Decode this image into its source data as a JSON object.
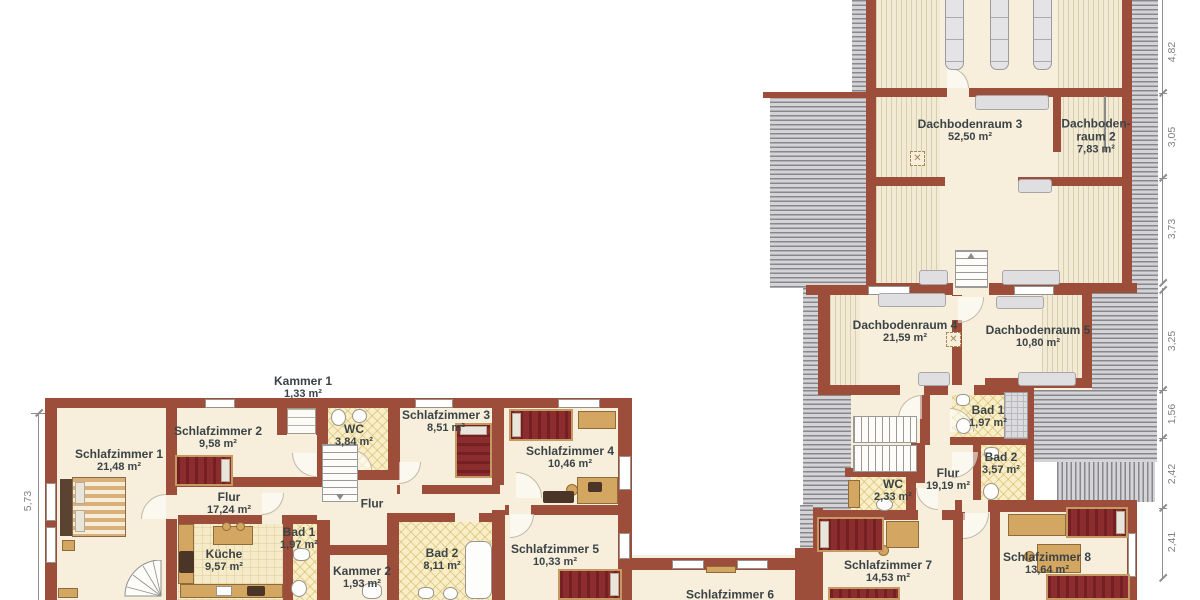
{
  "rooms": {
    "dachbodenraum3": {
      "name": "Dachbodenraum 3",
      "area": "52,50 m²"
    },
    "dachbodenraum2": {
      "name_line1": "Dachboden-",
      "name_line2": "raum 2",
      "area": "7,83 m²"
    },
    "dachbodenraum4": {
      "name": "Dachbodenraum 4",
      "area": "21,59 m²"
    },
    "dachbodenraum5": {
      "name": "Dachbodenraum 5",
      "area": "10,80 m²"
    },
    "bad1_right": {
      "name": "Bad 1",
      "area": "1,97 m²"
    },
    "bad2_right": {
      "name": "Bad 2",
      "area": "3,57 m²"
    },
    "flur_right": {
      "name": "Flur",
      "area": "19,19 m²"
    },
    "wc_right": {
      "name": "WC",
      "area": "2,33 m²"
    },
    "schlafzimmer7": {
      "name": "Schlafzimmer 7",
      "area": "14,53 m²"
    },
    "schlafzimmer8": {
      "name": "Schlafzimmer 8",
      "area": "13,64 m²"
    },
    "kammer1": {
      "name": "Kammer 1",
      "area": "1,33 m²"
    },
    "schlafzimmer1": {
      "name": "Schlafzimmer 1",
      "area": "21,48 m²"
    },
    "schlafzimmer2": {
      "name": "Schlafzimmer 2",
      "area": "9,58 m²"
    },
    "schlafzimmer3": {
      "name": "Schlafzimmer 3",
      "area": "8,51 m²"
    },
    "schlafzimmer4": {
      "name": "Schlafzimmer 4",
      "area": "10,46 m²"
    },
    "schlafzimmer5": {
      "name": "Schlafzimmer 5",
      "area": "10,33 m²"
    },
    "schlafzimmer6": {
      "name": "Schlafzimmer 6"
    },
    "wc_left": {
      "name": "WC",
      "area": "3,84 m²"
    },
    "flur_left": {
      "name": "Flur",
      "area": "17,24 m²"
    },
    "flur_left2": {
      "name": "Flur"
    },
    "kueche": {
      "name": "Küche",
      "area": "9,57 m²"
    },
    "bad1_left": {
      "name": "Bad 1",
      "area": "1,97 m²"
    },
    "bad2_left": {
      "name": "Bad 2",
      "area": "8,11 m²"
    },
    "kammer2": {
      "name": "Kammer 2",
      "area": "1,93 m²"
    }
  },
  "dimensions": {
    "right": [
      "4,82",
      "3,05",
      "3,73",
      "3,25",
      "1,56",
      "2,42",
      "2,41"
    ],
    "left": [
      "5,73"
    ]
  },
  "symbols": {
    "chimney": "✕"
  },
  "colors": {
    "wall": "#9c4e3a",
    "floor": "#f7efdb",
    "bed": "#8b2d2f",
    "text": "#3c4347",
    "hatch": "#88888c"
  }
}
